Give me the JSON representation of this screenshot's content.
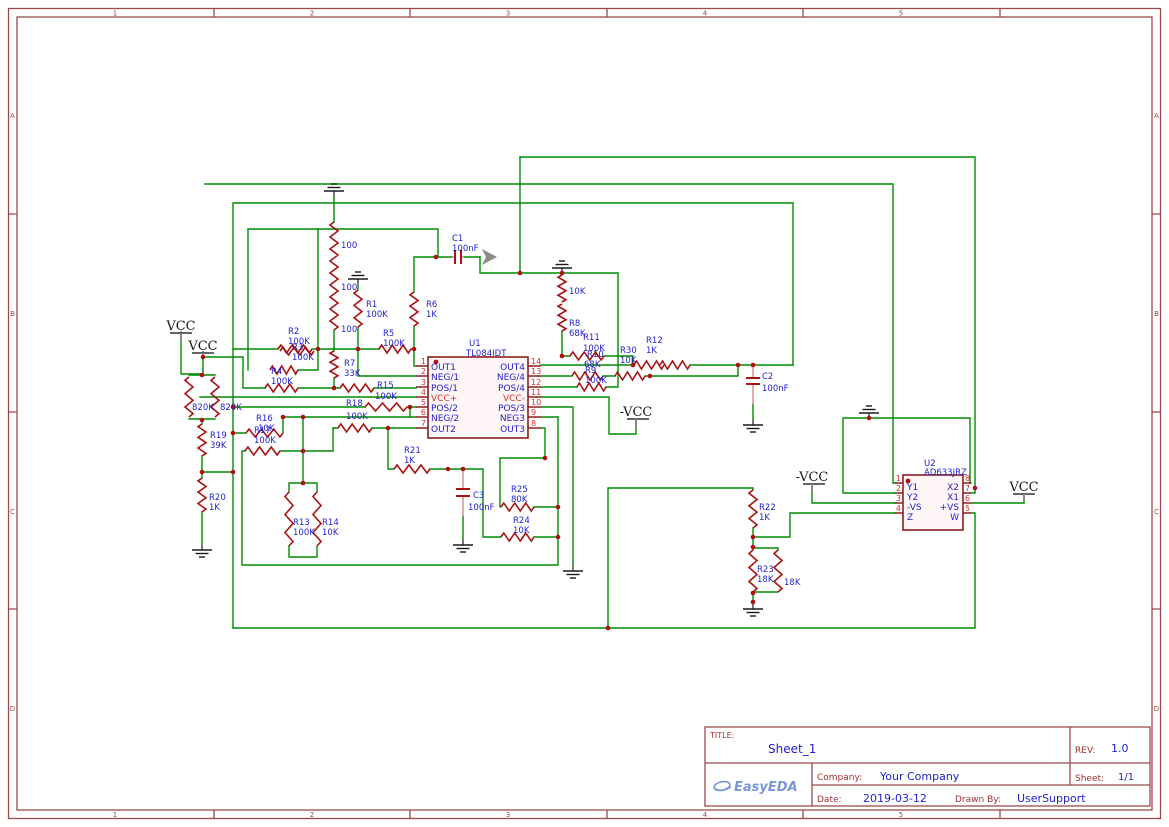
{
  "border": {
    "columns": [
      "1",
      "2",
      "3",
      "4",
      "5"
    ],
    "rows": [
      "A",
      "B",
      "C",
      "D"
    ]
  },
  "title_block": {
    "title_label": "TITLE:",
    "title": "Sheet_1",
    "rev_label": "REV:",
    "rev": "1.0",
    "company_label": "Company:",
    "company": "Your Company",
    "sheet_label": "Sheet:",
    "sheet": "1/1",
    "date_label": "Date:",
    "date": "2019-03-12",
    "drawn_label": "Drawn By:",
    "drawn_by": "UserSupport",
    "logo": "EasyEDA"
  },
  "nets": {
    "vcc": "VCC",
    "nvcc": "-VCC"
  },
  "u1": {
    "ref": "U1",
    "part": "TL084IDT",
    "pins_left": [
      {
        "n": "1",
        "name": "OUT1"
      },
      {
        "n": "2",
        "name": "NEG/1"
      },
      {
        "n": "3",
        "name": "POS/1"
      },
      {
        "n": "4",
        "name": "VCC+"
      },
      {
        "n": "5",
        "name": "POS/2"
      },
      {
        "n": "6",
        "name": "NEG/2"
      },
      {
        "n": "7",
        "name": "OUT2"
      }
    ],
    "pins_right": [
      {
        "n": "14",
        "name": "OUT4"
      },
      {
        "n": "13",
        "name": "NEG/4"
      },
      {
        "n": "12",
        "name": "POS/4"
      },
      {
        "n": "11",
        "name": "VCC-"
      },
      {
        "n": "10",
        "name": "POS/3"
      },
      {
        "n": "9",
        "name": "NEG3"
      },
      {
        "n": "8",
        "name": "OUT3"
      }
    ]
  },
  "u2": {
    "ref": "U2",
    "part": "AD633JRZ",
    "pins_left": [
      {
        "n": "1",
        "name": "Y1"
      },
      {
        "n": "2",
        "name": "Y2"
      },
      {
        "n": "3",
        "name": "-VS"
      },
      {
        "n": "4",
        "name": "Z"
      }
    ],
    "pins_right": [
      {
        "n": "8",
        "name": "X2"
      },
      {
        "n": "7",
        "name": "X1"
      },
      {
        "n": "6",
        "name": "+VS"
      },
      {
        "n": "5",
        "name": "W"
      }
    ]
  },
  "parts": {
    "r1": {
      "ref": "R1",
      "value": "100K"
    },
    "r2": {
      "ref": "R2",
      "value": "100K"
    },
    "r3": {
      "ref": "R3",
      "value": "100K"
    },
    "r4": {
      "ref": "R4",
      "value": "100K"
    },
    "r5": {
      "ref": "R5",
      "value": "100K"
    },
    "r6": {
      "ref": "R6",
      "value": "1K"
    },
    "r7": {
      "ref": "R7",
      "value": "33K"
    },
    "r8": {
      "ref": "R8",
      "value": "68K"
    },
    "r9": {
      "ref": "R9",
      "value": "100K"
    },
    "r10": {
      "ref": "R10",
      "value": "68K"
    },
    "r11": {
      "ref": "R11",
      "value": "100K"
    },
    "r12": {
      "ref": "R12",
      "value": "1K"
    },
    "r13": {
      "ref": "R13",
      "value": "100K"
    },
    "r14": {
      "ref": "R14",
      "value": "10K"
    },
    "r15": {
      "ref": "R15",
      "value": "100K"
    },
    "r16": {
      "ref": "R16",
      "value": "10K"
    },
    "r17": {
      "ref": "R17",
      "value": "100K"
    },
    "r18": {
      "ref": "R18",
      "value": "100K"
    },
    "r19": {
      "ref": "R19",
      "value": "39K"
    },
    "r20": {
      "ref": "R20",
      "value": "1K"
    },
    "r21": {
      "ref": "R21",
      "value": "1K"
    },
    "r22": {
      "ref": "R22",
      "value": "1K"
    },
    "r23": {
      "ref": "R23",
      "value": "18K"
    },
    "r23b": {
      "value": "18K"
    },
    "r24": {
      "ref": "R24",
      "value": "10K"
    },
    "r25": {
      "ref": "R25",
      "value": "80K"
    },
    "r30": {
      "ref": "R30",
      "value": "10K"
    },
    "r10k_top": {
      "value": "10K"
    },
    "r100_1": {
      "value": "100"
    },
    "r100_2": {
      "value": "100"
    },
    "r100_3": {
      "value": "100"
    },
    "r820_1": {
      "value": "820K"
    },
    "r820_2": {
      "value": "820K"
    },
    "c1": {
      "ref": "C1",
      "value": "100nF"
    },
    "c2": {
      "ref": "C2",
      "value": "100nF"
    },
    "c3": {
      "ref": "C3",
      "value": "100nF"
    }
  },
  "colors": {
    "wire": "#008b00",
    "component": "#a81414",
    "ic_outline": "#8b1f1f",
    "label": "#2222cc",
    "pin_number": "#cc3333",
    "border": "#9a4a4a",
    "logo": "#7a98d8",
    "junction": "#b01010"
  }
}
